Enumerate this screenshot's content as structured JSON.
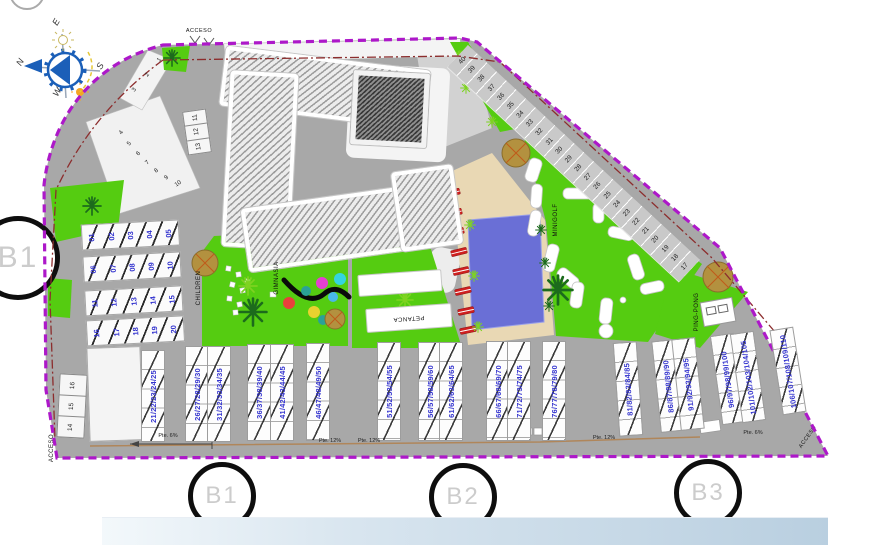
{
  "section_markers": {
    "left": "B1",
    "bottom": [
      "B1",
      "B2",
      "B3"
    ]
  },
  "compass": {
    "n": "N",
    "e": "E",
    "s": "S",
    "w": "W"
  },
  "access": {
    "top": "ACCESO",
    "left": "ACCESO",
    "right": "ACCESO"
  },
  "amenities": {
    "children": "CHILDREN",
    "gym": "GIMNASIA",
    "petanque": "PETANCA",
    "minigolf": "MINIGOLF",
    "pingpong": "PING-PONG"
  },
  "slopes": [
    "Pte. 6%",
    "Pte. 12%",
    "Pte. 12%",
    "Pte. 12%",
    "Pte. 6%"
  ],
  "parking": {
    "edge_spaces": [
      "1",
      "2",
      "3"
    ],
    "fan_spaces": [
      "4",
      "5",
      "6",
      "7",
      "8",
      "9",
      "10"
    ],
    "box_top": [
      "11",
      "12",
      "13"
    ],
    "box_left": [
      "16",
      "15",
      "14"
    ],
    "diagonal_spaces": [
      "40",
      "39",
      "38",
      "37",
      "36",
      "35",
      "34",
      "33",
      "32",
      "31",
      "30",
      "29",
      "28",
      "27",
      "26",
      "25",
      "24",
      "23",
      "22",
      "21",
      "20",
      "19",
      "18",
      "17"
    ]
  },
  "units": {
    "left_block_rows": [
      [
        "01",
        "02",
        "03",
        "04",
        "05"
      ],
      [
        "06",
        "07",
        "08",
        "09",
        "10"
      ],
      [
        "11",
        "12",
        "13",
        "14",
        "15"
      ],
      [
        "16",
        "17",
        "18",
        "19",
        "20"
      ]
    ],
    "bottom_rows": [
      "21/22/23/24/25",
      "26/27/28/29/30",
      "31/32/33/34/35",
      "36/37/38/39/40",
      "41/42/43/44/45",
      "46/47/48/49/50",
      "51/52/53/54/55",
      "56/57/58/59/60",
      "61/62/63/64/65",
      "66/67/68/69/70",
      "71/72/73/74/75",
      "76/77/78/79/80",
      "81/82/83/84/85",
      "86/87/88/89/90",
      "91/92/93/94/95",
      "96/97/98/99/100",
      "101/102/103/104/105",
      "106/107/108/109/110"
    ]
  },
  "colors": {
    "boundary": "#ad18c9",
    "road": "#a8a8a8",
    "green": "#55cc11",
    "pool": "#6a6fd6",
    "deck": "#e9d8b4",
    "lounger_red": "#cf1f1f",
    "unit_number_blue": "#3434cf",
    "marker_gray": "#cccccc",
    "bar_left": "#f3f8fb",
    "bar_right": "#b9cfe0"
  }
}
